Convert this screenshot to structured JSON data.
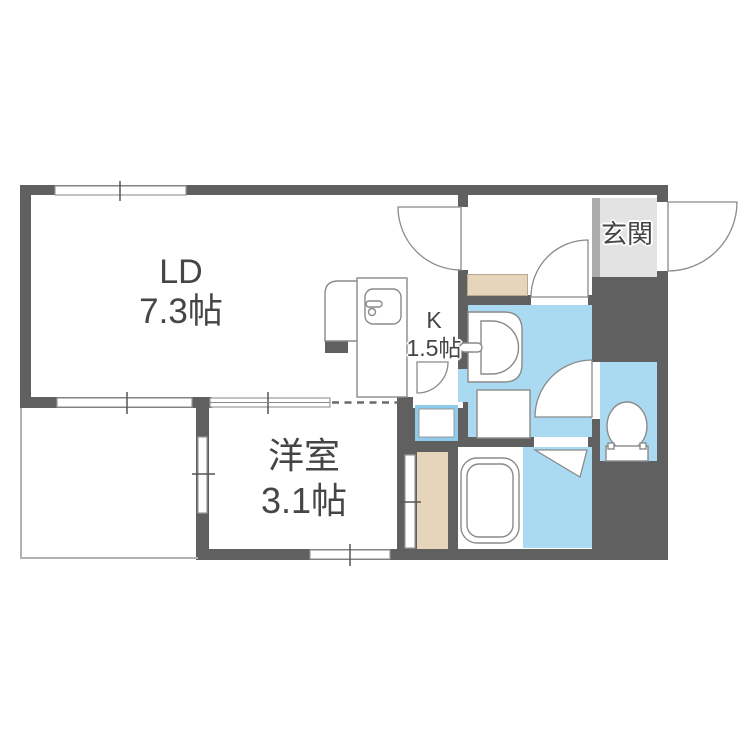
{
  "plan": {
    "type": "japanese-apartment-floor-plan",
    "rooms": {
      "ld": {
        "label": "LD",
        "size": "7.3帖"
      },
      "kitchen": {
        "label": "K",
        "size": "1.5帖"
      },
      "western_room": {
        "label": "洋室",
        "size": "3.1帖"
      },
      "entrance": {
        "label": "玄関"
      }
    },
    "colors": {
      "wall": "#606060",
      "water_area": "#a9daf2",
      "flooring_beige": "#e7d5bb",
      "entrance_floor": "#e3e3e3",
      "entrance_edge": "#ababab",
      "pan_border": "#8fcceb",
      "fixture_stroke": "#8a8a8a",
      "window_stroke": "#9a9a9a",
      "balcony_line": "#b3b3b3",
      "text": "#454545"
    },
    "fixtures": [
      "kitchen-counter-with-sink",
      "washbasin",
      "washing-machine-space",
      "washing-machine-pan",
      "bathtub",
      "toilet",
      "entrance-swing-door",
      "kitchen-swing-door",
      "washroom-swing-door",
      "toilet-swing-door",
      "bathroom-folding-door",
      "sliding-door",
      "window-ticks",
      "open-boundary-dashed",
      "balcony"
    ]
  }
}
